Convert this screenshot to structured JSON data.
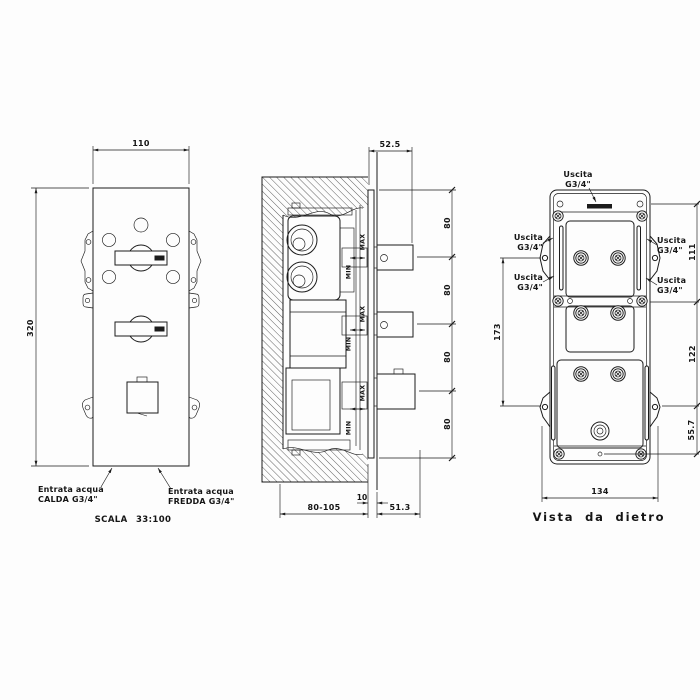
{
  "front_view": {
    "width_dim": "110",
    "height_dim": "320",
    "hot_inlet": {
      "line1": "Entrata acqua",
      "line2": "CALDA G3/4\""
    },
    "cold_inlet": {
      "line1": "Entrata acqua",
      "line2": "FREDDA G3/4\""
    },
    "scale_label": "SCALA 33:100"
  },
  "section_view": {
    "depth_dim": "52.5",
    "port_spacing_dims": [
      "80",
      "80",
      "80",
      "80"
    ],
    "recess_depth_dim": "80-105",
    "plate_thickness_dim": "10",
    "projection_dim": "51.3",
    "max_label": "MAX",
    "min_label": "MIN"
  },
  "rear_view": {
    "caption": "Vista da dietro",
    "outlet_label": {
      "line1": "Uscita",
      "line2": "G3/4\""
    },
    "left_height_dim": "173",
    "right_top_dim": "111",
    "right_mid_dim": "122",
    "right_bottom_dim": "55.7",
    "width_dim": "134"
  },
  "colors": {
    "line": "#1b1b1b",
    "background": "#fdfdfd"
  }
}
